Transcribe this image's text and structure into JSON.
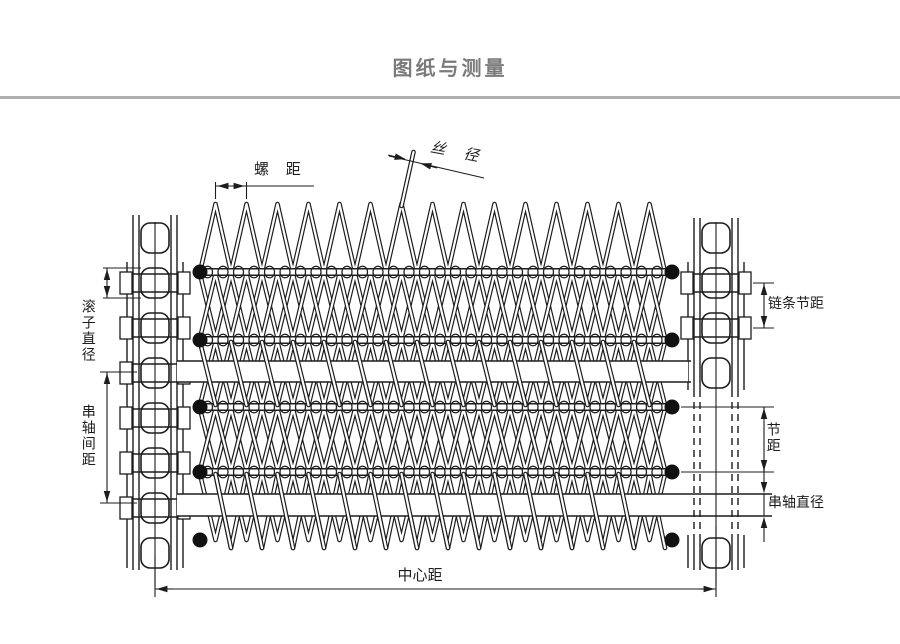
{
  "title": "图纸与测量",
  "labels": {
    "screw_pitch": "螺 距",
    "wire_diameter": "丝 径",
    "roller_diameter": "滚子直径",
    "shaft_spacing": "串轴间距",
    "chain_pitch": "链条节距",
    "pitch": "节距",
    "shaft_diameter": "串轴直径",
    "center_distance": "中心距"
  },
  "colors": {
    "line": "#1d1d1d",
    "title": "#7b7b7b",
    "divider": "#b0b0b0",
    "background": "#ffffff"
  }
}
